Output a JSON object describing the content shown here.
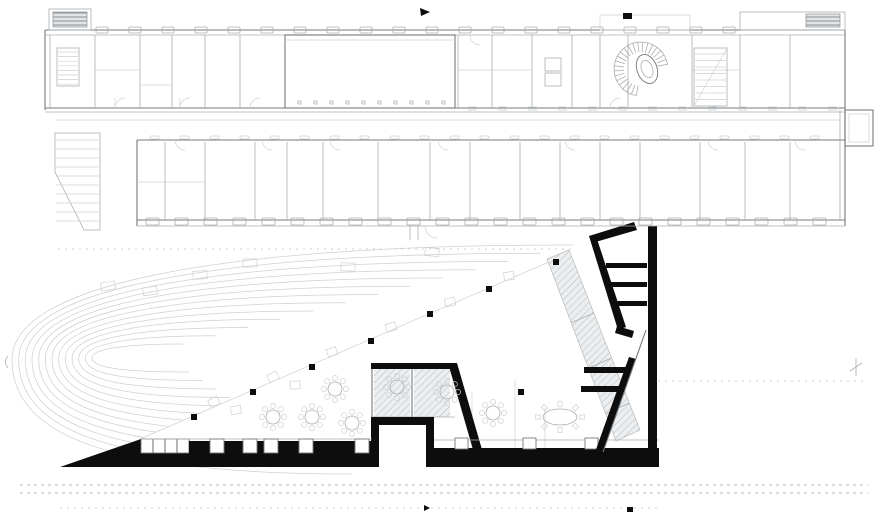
{
  "drawing": {
    "type": "architectural-floor-plan",
    "label": "ground-floor-plan-existing-building-with-new-angular-hall",
    "colors": {
      "line_faint": "#cdd1d4",
      "line_light": "#a9aeb2",
      "line_medium": "#74797d",
      "poche_black": "#0d0d0d",
      "hatch_fill": "#e6e8e9"
    },
    "contours": {
      "count": 13
    },
    "contour_benches": [
      [
        108,
        286
      ],
      [
        150,
        291
      ],
      [
        200,
        275
      ],
      [
        250,
        263
      ],
      [
        348,
        267
      ],
      [
        432,
        252
      ]
    ],
    "upper_building": {
      "window_rows": [
        {
          "name": "north-facade-windows",
          "x0": 96,
          "step": 33,
          "count": 20,
          "y": 27,
          "w": 12,
          "h": 6
        },
        {
          "name": "south-facade-windows",
          "x0": 146,
          "step": 29,
          "count": 24,
          "y": 218,
          "w": 13,
          "h": 7
        },
        {
          "name": "courtyard-upper-ticks",
          "x0": 468,
          "step": 30,
          "count": 13,
          "y": 107,
          "w": 9,
          "h": 3
        },
        {
          "name": "courtyard-lower-ticks",
          "x0": 150,
          "step": 30,
          "count": 23,
          "y": 136,
          "w": 9,
          "h": 3
        }
      ],
      "hall_column_ticks": {
        "x0": 298,
        "step": 16,
        "count": 10,
        "y": 101,
        "s": 3
      },
      "north_partitions": [
        95,
        140,
        172,
        205,
        240,
        458,
        492,
        532,
        572,
        600,
        628,
        692,
        740,
        790
      ],
      "south_partitions": [
        165,
        205,
        255,
        287,
        323,
        378,
        430,
        470,
        520,
        560,
        600,
        640,
        700,
        745,
        790
      ],
      "tread_rows": [
        {
          "x1": 695,
          "x2": 726,
          "y0": 54,
          "dy": 6.5,
          "n": 8
        },
        {
          "x1": 58,
          "x2": 78,
          "y0": 52,
          "dy": 4.6,
          "n": 8
        },
        {
          "x1": 56,
          "x2": 99,
          "y0": 140,
          "dy": 9,
          "n": 10
        }
      ],
      "spiral_stair": {
        "cx": 641,
        "cy": 69,
        "r1": 17,
        "r2": 27,
        "a0": 100,
        "a1": 350,
        "n": 23
      }
    },
    "lower_hall": {
      "columns": [
        [
          556,
          262
        ],
        [
          489,
          289
        ],
        [
          430,
          314
        ],
        [
          371,
          341
        ],
        [
          312,
          367
        ],
        [
          253,
          392
        ],
        [
          194,
          417
        ],
        [
          521,
          392
        ]
      ],
      "lounge_chairs": [
        [
          214,
          402
        ],
        [
          273,
          377
        ],
        [
          332,
          352
        ],
        [
          391,
          327
        ],
        [
          450,
          302
        ],
        [
          509,
          276
        ],
        [
          236,
          410
        ],
        [
          295,
          385
        ]
      ],
      "flower_tables": [
        [
          273,
          417
        ],
        [
          312,
          417
        ],
        [
          352,
          423
        ],
        [
          335,
          389
        ],
        [
          397,
          387
        ],
        [
          447,
          392
        ],
        [
          493,
          413
        ]
      ],
      "oval_table": {
        "cx": 560,
        "cy": 417,
        "rx": 17,
        "ry": 8,
        "chairs": 8
      },
      "bottom_openings_left": {
        "xs": [
          210,
          243,
          264,
          299,
          355
        ],
        "y": 439,
        "w": 14,
        "h": 14
      },
      "bottom_openings_right": {
        "xs": [
          455,
          523,
          585
        ],
        "y": 438,
        "w": 13,
        "h": 11
      },
      "stair_bars": [
        [
          606,
          263,
          41,
          5
        ],
        [
          610,
          282,
          37,
          5
        ],
        [
          614,
          301,
          33,
          5
        ],
        [
          584,
          367,
          44,
          6
        ],
        [
          581,
          386,
          43,
          6
        ]
      ],
      "hatch_band": {
        "pts": "547,259 569,250 640,430 616,441",
        "cross_t": [
          0.35,
          0.6,
          0.85
        ]
      }
    }
  }
}
